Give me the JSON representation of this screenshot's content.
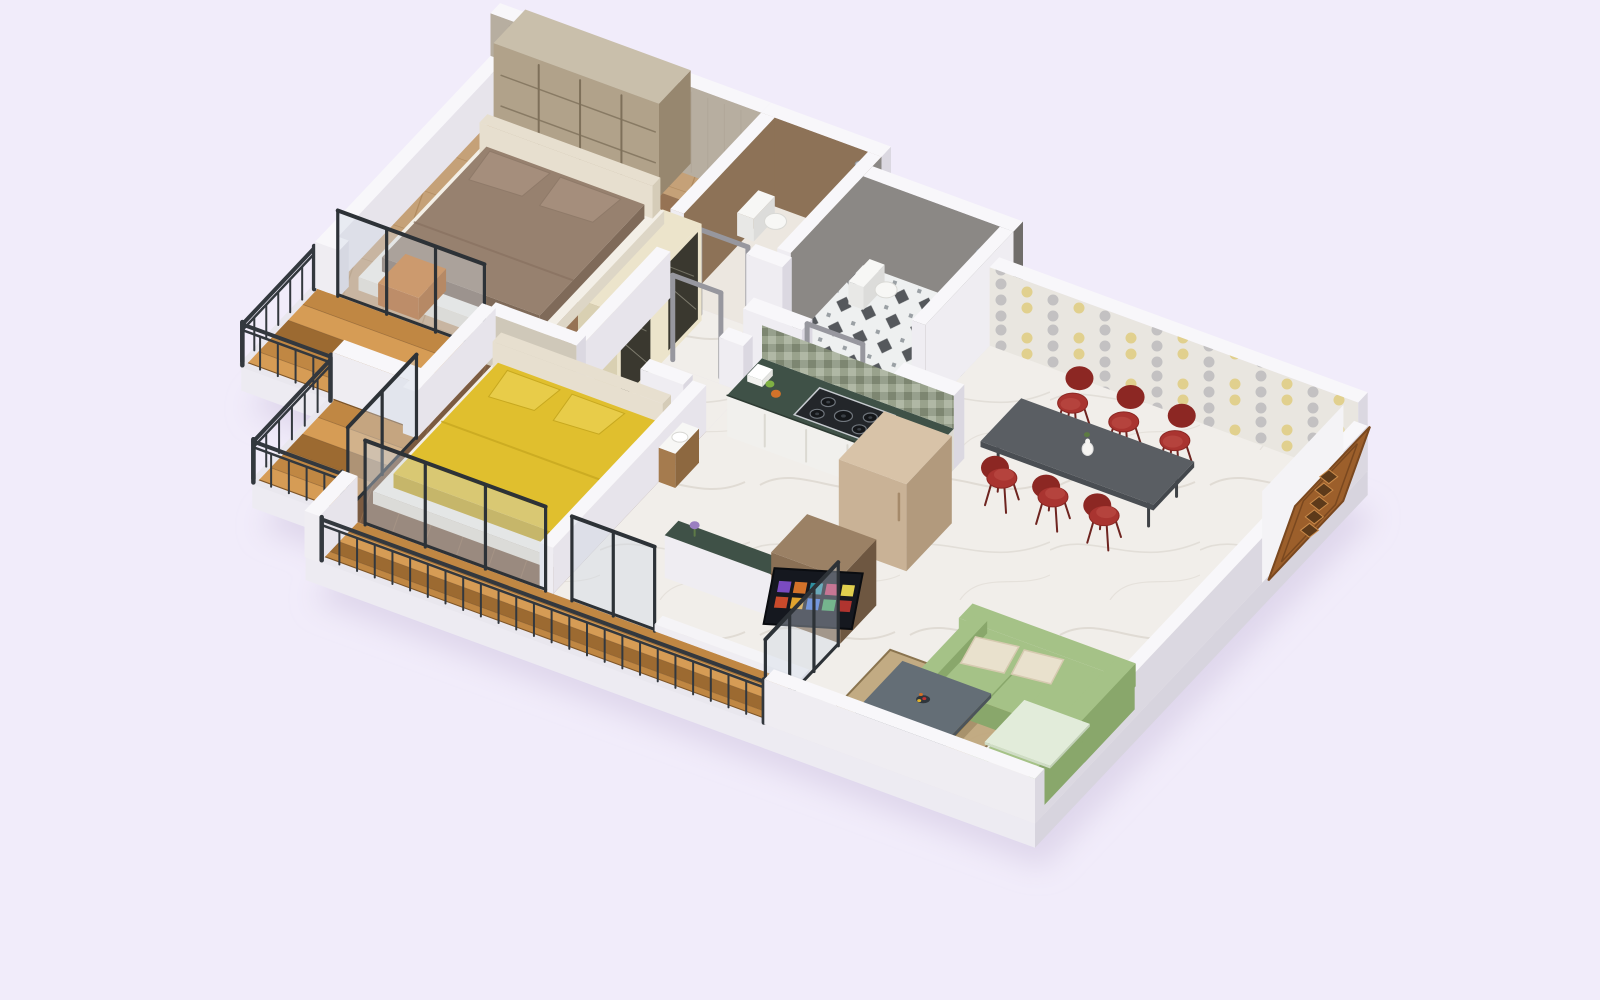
{
  "scene": {
    "view": "isometric-3d-render",
    "background": "#f1ecfa",
    "description": "3D isometric dollhouse floor plan render of an apartment with master bedroom, second bedroom with yellow bed, two bathrooms, kitchen, dining area with red chairs, living room with green L-shaped sofa, TV unit, wooden entrance door and three stepped wooden balconies with dark railings"
  },
  "rooms": [
    {
      "name": "master-bedroom"
    },
    {
      "name": "master-bathroom"
    },
    {
      "name": "common-bathroom"
    },
    {
      "name": "passage"
    },
    {
      "name": "second-bedroom"
    },
    {
      "name": "kitchen"
    },
    {
      "name": "dining-area"
    },
    {
      "name": "living-room"
    },
    {
      "name": "balcony-master"
    },
    {
      "name": "balcony-middle"
    },
    {
      "name": "balcony-long"
    }
  ],
  "furniture": [
    "master-double-bed",
    "master-wardrobe",
    "orange-bedside-stool",
    "yellow-double-bed",
    "hall-wardrobe-with-mirror",
    "kitchen-counter-with-gas-stove",
    "refrigerator",
    "wash-basin",
    "dining-table",
    "dining-chairs-x6",
    "flower-vase",
    "tv-unit",
    "television",
    "green-l-shaped-sofa",
    "cream-cushions",
    "coffee-table",
    "fruit-bowl",
    "area-rug",
    "toilets-x2",
    "shower-panels-x2",
    "main-entrance-door",
    "balcony-railings",
    "glass-sliding-doors",
    "wooden-deck-flooring"
  ],
  "colors": {
    "bg": "#f1ecfa",
    "shadow": "#cfc5e0",
    "slabLight": "#edebf2",
    "slabDark": "#d7d4de",
    "slabMid": "#e2dfe8",
    "wallTop": "#f8f7fa",
    "wallFaceLight": "#efedf2",
    "wallFaceShade": "#dbd8e1",
    "wallInner": "#e7e4eb",
    "beigeWall": "#b7aea0",
    "beigeWallDark": "#a59b8b",
    "beigeLow": "#cfc8b9",
    "brownWall": "#8d7257",
    "grayWall": "#8b8885",
    "grayWallDark": "#706d6a",
    "doorFrameGray": "#97979e",
    "steel": "#c6cacf",
    "wallpaperBase": "#e9e6e0",
    "wallpaperGray": "#bcbbbd",
    "wallpaperYellow": "#dfcb79",
    "marble": "#f1eeea",
    "marbleVein": "#d9d3cb",
    "bathFloor": "#ece7e0",
    "woodMaster": "#c5a178",
    "woodMasterLine": "#b08a5e",
    "woodMasterDark": "#8f6c4e",
    "woodDark": "#7b5b41",
    "woodDarkLine": "#8d6a4b",
    "deckA": "#c08743",
    "deckB": "#9c6a31",
    "deckC": "#d69c55",
    "deckEdge": "#7e5527",
    "rail": "#33383e",
    "frame": "#2d3237",
    "glass": "#cdd8e4",
    "wrFace": "#b1a28a",
    "wrSide": "#97876f",
    "wrTop": "#c9bfab",
    "wrLine": "#7e705a",
    "wrCream": "#ece4cb",
    "wrCreamSide": "#d9d0b2",
    "mirror": "#3a382f",
    "mirrorLine": "#9a9787",
    "bedBase": "#f3efe7",
    "bedBaseSide": "#e4ded0",
    "headboard": "#e7dfcf",
    "bedBrown": "#97816f",
    "bedBrownDark": "#7f6a59",
    "pillowBrown": "#a58e7c",
    "bedYellow": "#e0bf2e",
    "bedYellowDark": "#c2a21f",
    "pillowYellow": "#e8cc49",
    "stool": "#cc7426",
    "stoolDark": "#a85a17",
    "counterTop": "#3f5147",
    "cabinet": "#f1f0ed",
    "cabinetShade": "#dbd9d2",
    "mosaicBase": "#97a08d",
    "stove": "#23262a",
    "fridge": "#c9b296",
    "fridgeSide": "#b29a7d",
    "fridgeTop": "#d8c3a8",
    "tvUnit": "#8a7055",
    "tvUnitDark": "#6e5741",
    "tvUnitTop": "#9b8165",
    "tvScreen": "#15181f",
    "tableTop": "#5a5e63",
    "tableLeg": "#3f4246",
    "chairRed": "#a93430",
    "chairRedDark": "#8c2723",
    "sofaGreen": "#a5c287",
    "sofaGreenDark": "#89a76b",
    "sofaSeat": "#e2ecda",
    "cushion": "#e9e1cd",
    "ctTop": "#646e76",
    "ctTopSide": "#565f66",
    "ctGold": "#c49a4a",
    "rug": "#c0a87e",
    "rugDark": "#8a744f",
    "doorWood": "#9c5f2b",
    "doorWoodDark": "#5d3a1a",
    "doorWoodLight": "#c98a4a",
    "fixture": "#f7f7f5",
    "basinWood": "#a57b4e",
    "flowerPurple": "#9a7fc0"
  }
}
